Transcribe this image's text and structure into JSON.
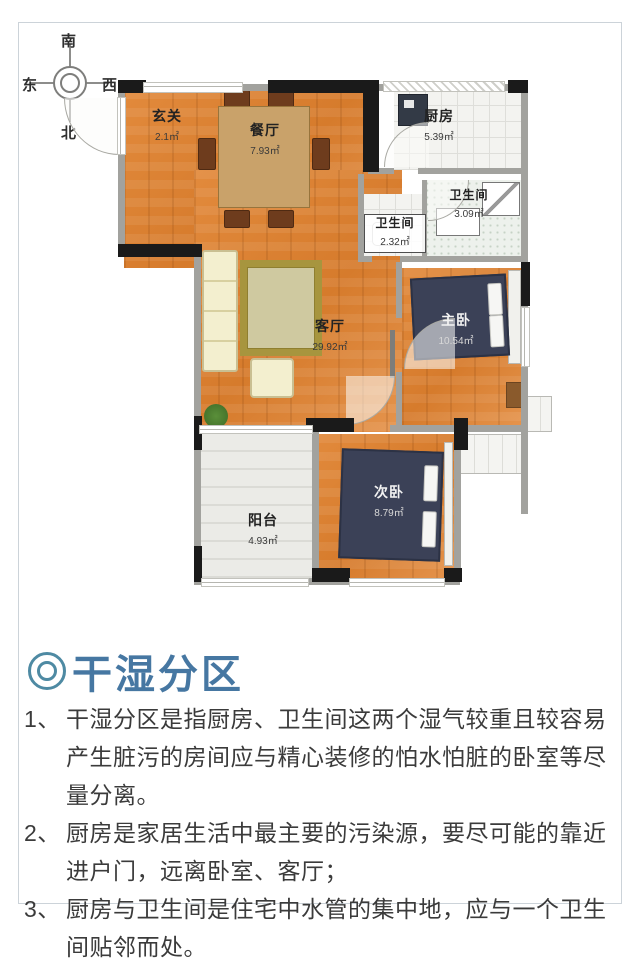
{
  "compass": {
    "south": "南",
    "north": "北",
    "east": "东",
    "west": "西"
  },
  "plan": {
    "unit": "㎡",
    "rooms": [
      {
        "id": "entrance",
        "name": "玄关",
        "area": "2.1㎡"
      },
      {
        "id": "dining",
        "name": "餐厅",
        "area": "7.93㎡"
      },
      {
        "id": "kitchen",
        "name": "厨房",
        "area": "5.39㎡"
      },
      {
        "id": "bath-small",
        "name": "卫生间",
        "area": "2.32㎡"
      },
      {
        "id": "bath-large",
        "name": "卫生间",
        "area": "3.09㎡"
      },
      {
        "id": "living",
        "name": "客厅",
        "area": "29.92㎡"
      },
      {
        "id": "master",
        "name": "主卧",
        "area": "10.54㎡"
      },
      {
        "id": "secondary",
        "name": "次卧",
        "area": "8.79㎡"
      },
      {
        "id": "balcony",
        "name": "阳台",
        "area": "4.93㎡"
      }
    ]
  },
  "section": {
    "bullet": "◎",
    "title": "干湿分区",
    "title_color": "#4677a2",
    "items": [
      {
        "num": "1、",
        "text": "干湿分区是指厨房、卫生间这两个湿气较重且较容易产生脏污的房间应与精心装修的怕水怕脏的卧室等尽量分离。"
      },
      {
        "num": "2、",
        "text": "厨房是家居生活中最主要的污染源，要尽可能的靠近进户门，远离卧室、客厅；"
      },
      {
        "num": "3、",
        "text": "厨房与卫生间是住宅中水管的集中地，应与一个卫生间贴邻而处。"
      }
    ]
  }
}
